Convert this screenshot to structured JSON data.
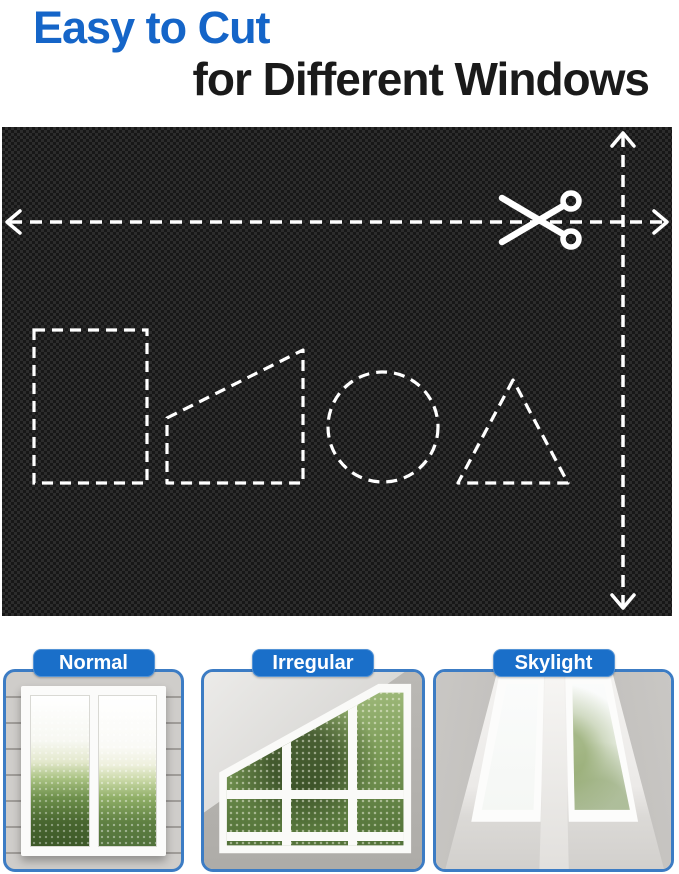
{
  "title": {
    "line1": "Easy to Cut",
    "line2": "for Different Windows"
  },
  "colors": {
    "title_blue": "#1565c8",
    "title_black": "#1a1a1a",
    "accent_blue": "#1a6fc9",
    "card_border_blue": "#3c7cc4",
    "fabric_black": "#171717",
    "cut_line_white": "#ffffff"
  },
  "fabric_diagram": {
    "description": "black blackout fabric with dashed cut guides",
    "cut_lines": [
      "horizontal dashed line with left/right arrows and scissors",
      "vertical dashed line with up/down arrows"
    ],
    "cut_shapes": [
      "rectangle",
      "trapezoid",
      "circle",
      "triangle"
    ],
    "tool_icon": "scissors-icon"
  },
  "cards": [
    {
      "label": "Normal",
      "type": "normal-window"
    },
    {
      "label": "Irregular",
      "type": "irregular-window"
    },
    {
      "label": "Skylight",
      "type": "skylight-window"
    }
  ]
}
